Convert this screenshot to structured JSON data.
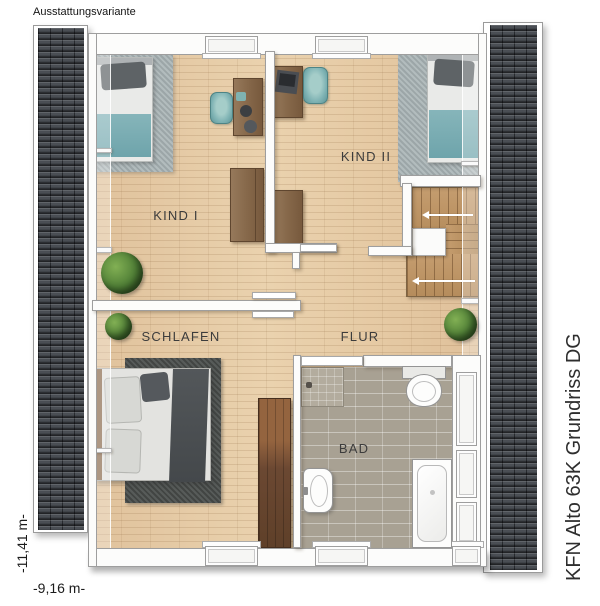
{
  "page": {
    "variant_label": "Ausstattungsvariante",
    "plan_title": "KFN Alto 63K Grundriss DG"
  },
  "dimensions": {
    "height_label": "-11,41 m-",
    "width_label": "-9,16 m-"
  },
  "rooms": {
    "kind1": "KIND I",
    "kind2": "KIND II",
    "schlafen": "SCHLAFEN",
    "flur": "FLUR",
    "bad": "BAD"
  },
  "colors": {
    "roof_tile": "#4a4e54",
    "wood_floor": "#e6cda9",
    "bath_tile": "#a8a193",
    "accent_teal": "#7fb3b4",
    "kids_rug_gray": "#a9b4b6",
    "master_rug_dark": "#4d514f",
    "furniture_brown": "#86684a",
    "wardrobe_brown": "#6b4832",
    "stair_wood": "#c59d6f",
    "wall_white": "#fcfcfb"
  }
}
